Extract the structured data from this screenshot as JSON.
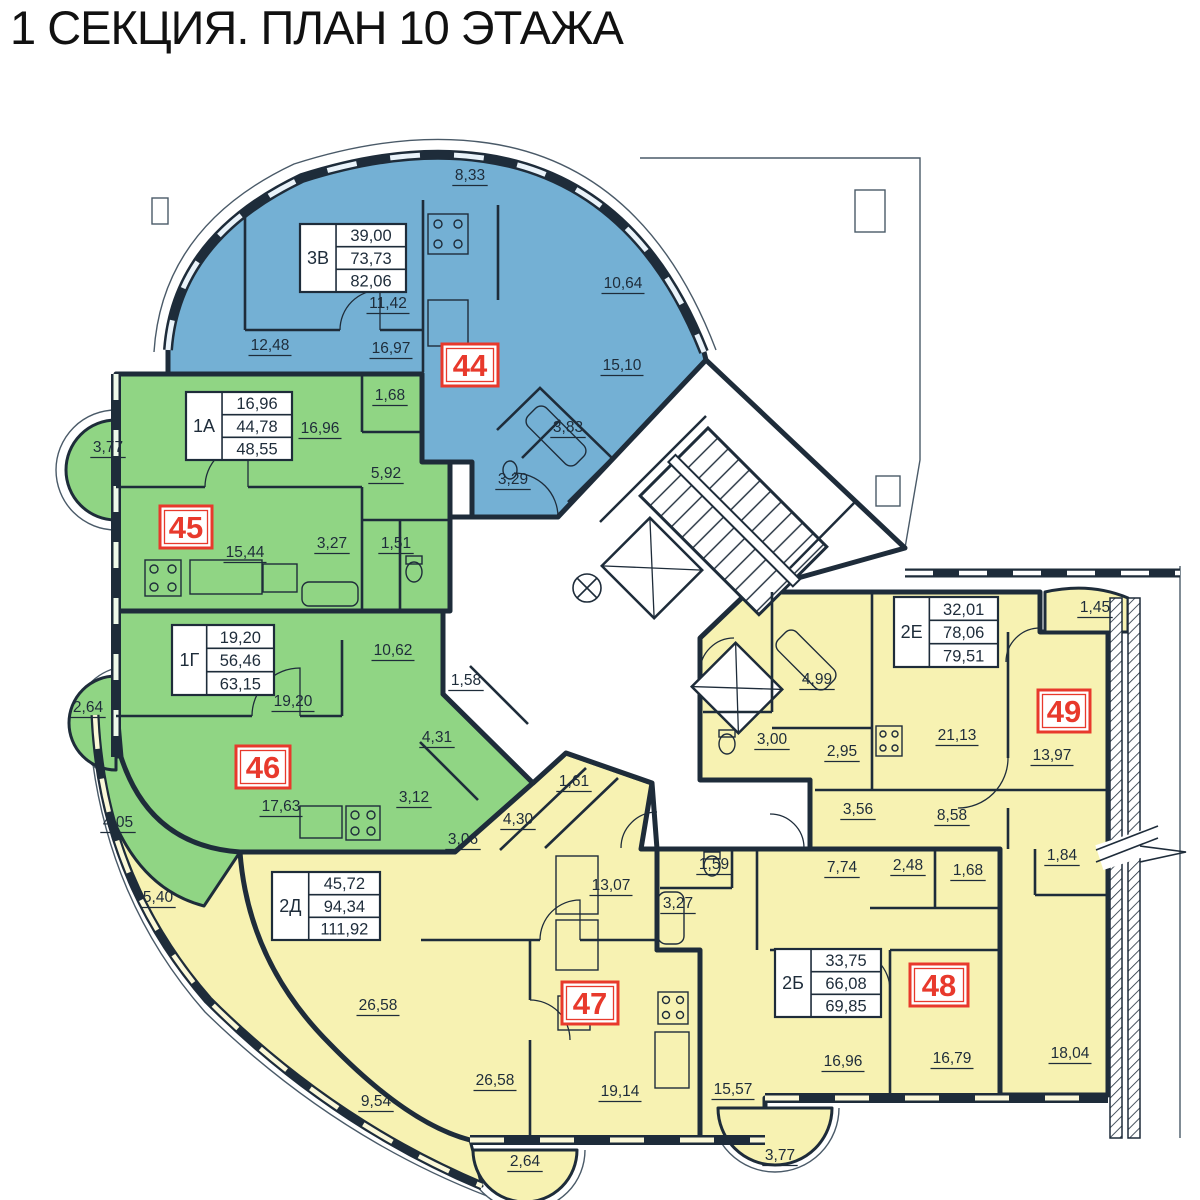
{
  "title": "1 СЕКЦИЯ. ПЛАН 10 ЭТАЖА",
  "colors": {
    "apartment_blue": "#74b0d4",
    "apartment_green": "#90d584",
    "apartment_yellow": "#f7f2b2",
    "wall": "#1e2c3a",
    "red_accent": "#e8392c",
    "background": "#ffffff"
  },
  "apartments": [
    {
      "number": "44",
      "type": "3В",
      "areas": [
        "39,00",
        "73,73",
        "82,06"
      ],
      "color": "apartment_blue",
      "number_box": {
        "x": 442,
        "y": 344,
        "w": 56,
        "h": 42
      },
      "info_box": {
        "x": 300,
        "y": 224,
        "w": 106,
        "h": 68
      },
      "labels": [
        {
          "text": "8,33",
          "x": 470,
          "y": 180
        },
        {
          "text": "11,42",
          "x": 388,
          "y": 308
        },
        {
          "text": "10,64",
          "x": 623,
          "y": 288
        },
        {
          "text": "12,48",
          "x": 270,
          "y": 350
        },
        {
          "text": "16,97",
          "x": 391,
          "y": 353
        },
        {
          "text": "15,10",
          "x": 622,
          "y": 370
        },
        {
          "text": "3,83",
          "x": 568,
          "y": 432
        },
        {
          "text": "3,29",
          "x": 513,
          "y": 484
        }
      ]
    },
    {
      "number": "45",
      "type": "1А",
      "areas": [
        "16,96",
        "44,78",
        "48,55"
      ],
      "color": "apartment_green",
      "number_box": {
        "x": 160,
        "y": 506,
        "w": 52,
        "h": 42
      },
      "info_box": {
        "x": 186,
        "y": 392,
        "w": 106,
        "h": 68
      },
      "labels": [
        {
          "text": "3,77",
          "x": 108,
          "y": 452
        },
        {
          "text": "16,96",
          "x": 320,
          "y": 433
        },
        {
          "text": "1,68",
          "x": 390,
          "y": 400
        },
        {
          "text": "5,92",
          "x": 386,
          "y": 478
        },
        {
          "text": "15,44",
          "x": 245,
          "y": 557
        },
        {
          "text": "3,27",
          "x": 332,
          "y": 548
        },
        {
          "text": "1,51",
          "x": 396,
          "y": 548
        }
      ]
    },
    {
      "number": "46",
      "type": "1Г",
      "areas": [
        "19,20",
        "56,46",
        "63,15"
      ],
      "color": "apartment_green",
      "number_box": {
        "x": 236,
        "y": 746,
        "w": 54,
        "h": 42
      },
      "info_box": {
        "x": 172,
        "y": 625,
        "w": 102,
        "h": 70
      },
      "labels": [
        {
          "text": "2,64",
          "x": 88,
          "y": 712
        },
        {
          "text": "19,20",
          "x": 293,
          "y": 706
        },
        {
          "text": "10,62",
          "x": 393,
          "y": 655
        },
        {
          "text": "1,58",
          "x": 466,
          "y": 685
        },
        {
          "text": "4,31",
          "x": 437,
          "y": 742
        },
        {
          "text": "3,12",
          "x": 414,
          "y": 802
        },
        {
          "text": "17,63",
          "x": 281,
          "y": 811
        },
        {
          "text": "4,05",
          "x": 118,
          "y": 827
        }
      ]
    },
    {
      "number": "47",
      "type": "2Д",
      "areas": [
        "45,72",
        "94,34",
        "111,92"
      ],
      "color": "apartment_yellow",
      "number_box": {
        "x": 562,
        "y": 982,
        "w": 56,
        "h": 42
      },
      "info_box": {
        "x": 272,
        "y": 872,
        "w": 108,
        "h": 68
      },
      "labels": [
        {
          "text": "3,06",
          "x": 463,
          "y": 844
        },
        {
          "text": "4,30",
          "x": 518,
          "y": 824
        },
        {
          "text": "1,61",
          "x": 574,
          "y": 786
        },
        {
          "text": "13,07",
          "x": 611,
          "y": 890
        },
        {
          "text": "26,58",
          "x": 378,
          "y": 1010
        },
        {
          "text": "26,58",
          "x": 495,
          "y": 1085
        },
        {
          "text": "19,14",
          "x": 620,
          "y": 1096
        },
        {
          "text": "5,40",
          "x": 158,
          "y": 902
        },
        {
          "text": "9,54",
          "x": 376,
          "y": 1106
        },
        {
          "text": "2,64",
          "x": 525,
          "y": 1166
        }
      ]
    },
    {
      "number": "48",
      "type": "2Б",
      "areas": [
        "33,75",
        "66,08",
        "69,85"
      ],
      "color": "apartment_yellow",
      "number_box": {
        "x": 910,
        "y": 964,
        "w": 58,
        "h": 42
      },
      "info_box": {
        "x": 775,
        "y": 949,
        "w": 106,
        "h": 68
      },
      "labels": [
        {
          "text": "1,59",
          "x": 714,
          "y": 869
        },
        {
          "text": "3,27",
          "x": 678,
          "y": 908
        },
        {
          "text": "7,74",
          "x": 842,
          "y": 872
        },
        {
          "text": "2,48",
          "x": 908,
          "y": 870
        },
        {
          "text": "1,68",
          "x": 968,
          "y": 875
        },
        {
          "text": "16,96",
          "x": 843,
          "y": 1066
        },
        {
          "text": "16,79",
          "x": 952,
          "y": 1063
        },
        {
          "text": "15,57",
          "x": 733,
          "y": 1094
        },
        {
          "text": "3,77",
          "x": 780,
          "y": 1160
        }
      ]
    },
    {
      "number": "49",
      "type": "2Е",
      "areas": [
        "32,01",
        "78,06",
        "79,51"
      ],
      "color": "apartment_yellow",
      "number_box": {
        "x": 1038,
        "y": 690,
        "w": 52,
        "h": 42
      },
      "info_box": {
        "x": 894,
        "y": 597,
        "w": 104,
        "h": 70
      },
      "labels": [
        {
          "text": "1,45",
          "x": 1095,
          "y": 612
        },
        {
          "text": "4,99",
          "x": 817,
          "y": 684
        },
        {
          "text": "3,00",
          "x": 772,
          "y": 744
        },
        {
          "text": "2,95",
          "x": 842,
          "y": 756
        },
        {
          "text": "21,13",
          "x": 957,
          "y": 740
        },
        {
          "text": "13,97",
          "x": 1052,
          "y": 760
        },
        {
          "text": "3,56",
          "x": 858,
          "y": 814
        },
        {
          "text": "8,58",
          "x": 952,
          "y": 820
        },
        {
          "text": "1,84",
          "x": 1062,
          "y": 860
        },
        {
          "text": "18,04",
          "x": 1070,
          "y": 1058
        }
      ]
    }
  ]
}
